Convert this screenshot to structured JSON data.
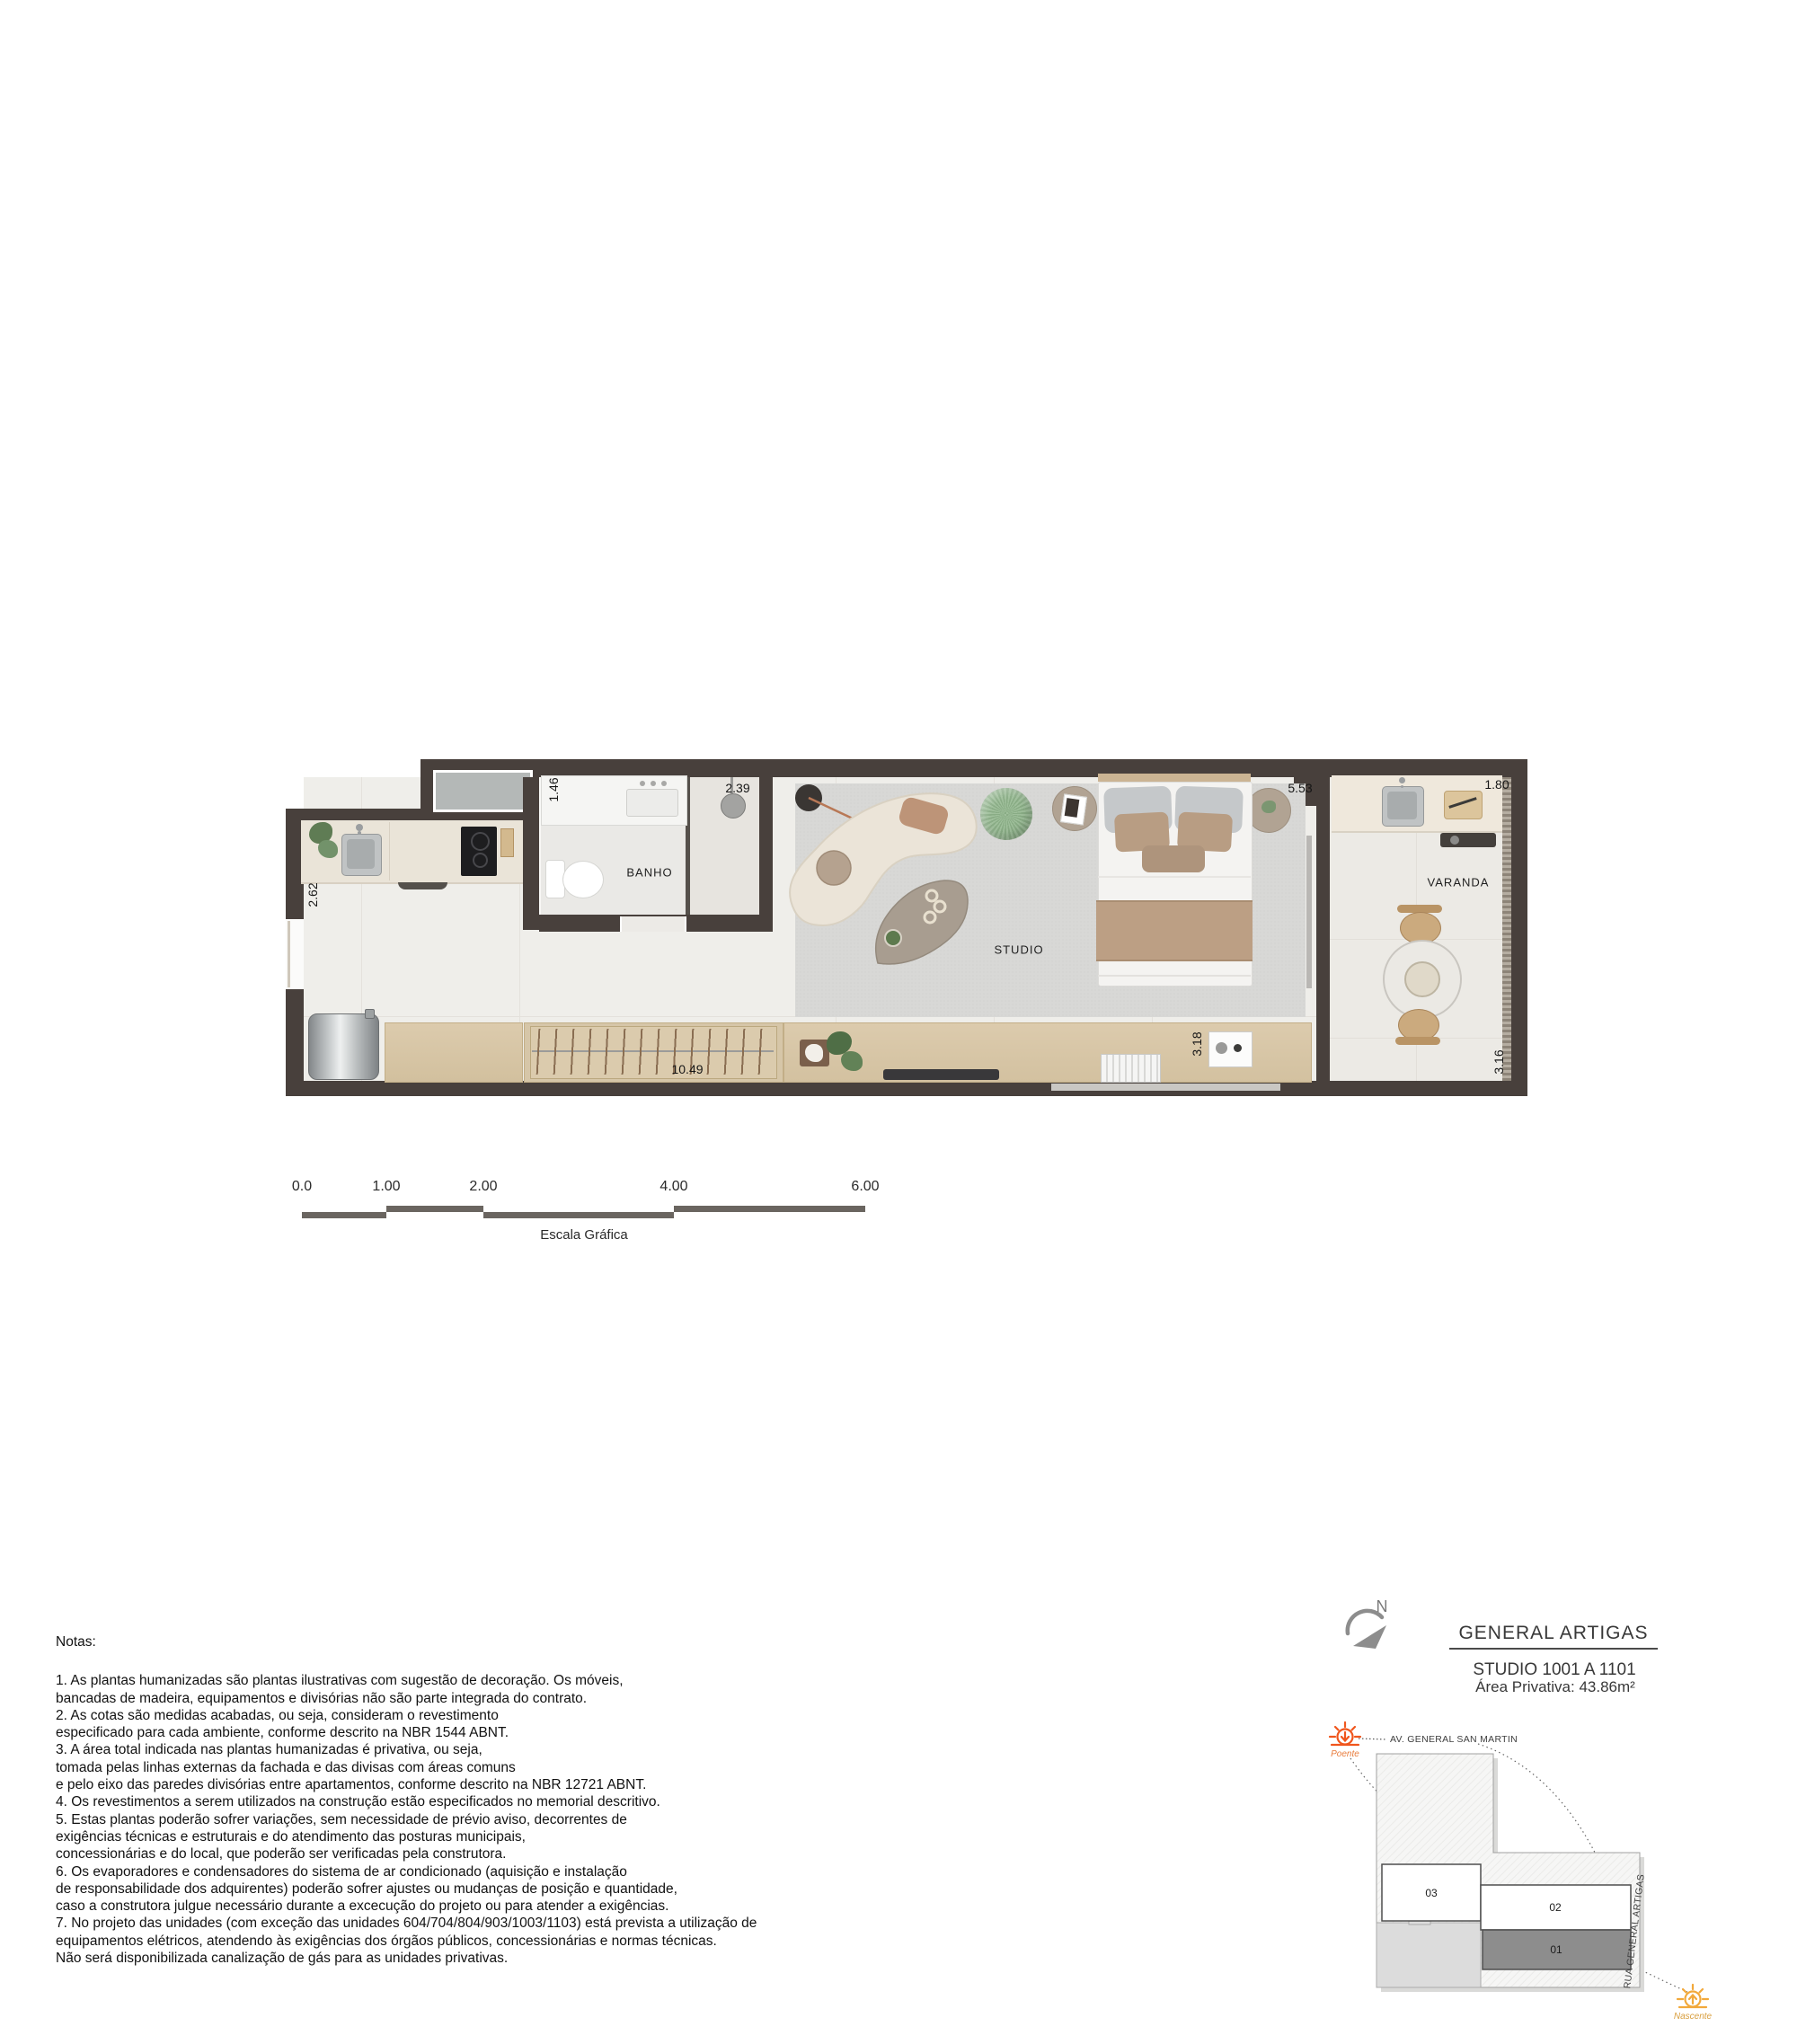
{
  "plan": {
    "room_labels": {
      "bathroom": "BANHO",
      "studio": "STUDIO",
      "balcony": "VARANDA"
    },
    "dimensions": {
      "kitchen_depth": "2.62",
      "bath_width": "1.46",
      "shower_width": "2.39",
      "studio_width": "5.53",
      "balcony_width": "1.80",
      "unit_length": "10.49",
      "console_width": "3.18",
      "balcony_length": "3.16"
    }
  },
  "scale_bar": {
    "ticks": [
      "0.0",
      "1.00",
      "2.00",
      "4.00",
      "6.00"
    ],
    "caption": "Escala Gráfica"
  },
  "notes": {
    "heading": "Notas:",
    "lines": [
      "1. As plantas humanizadas são plantas ilustrativas com sugestão de decoração. Os móveis,",
      "bancadas de madeira, equipamentos e divisórias não são parte integrada do contrato.",
      "2. As cotas são medidas acabadas, ou seja, consideram o revestimento",
      "especificado para cada ambiente, conforme descrito na NBR 1544 ABNT.",
      "3. A área total indicada nas plantas humanizadas é privativa, ou seja,",
      "tomada pelas linhas externas da fachada e das divisas com áreas comuns",
      "e pelo eixo das paredes divisórias entre apartamentos, conforme descrito na NBR 12721 ABNT.",
      "4. Os revestimentos a serem utilizados na construção estão especificados no memorial descritivo.",
      "5. Estas plantas poderão sofrer variações, sem necessidade de prévio aviso, decorrentes de",
      "exigências técnicas e estruturais e do atendimento das posturas municipais,",
      "concessionárias e do local, que poderão ser verificadas pela construtora.",
      "6. Os evaporadores e condensadores do sistema de ar condicionado (aquisição e instalação",
      "de responsabilidade dos adquirentes) poderão sofrer ajustes ou mudanças de posição e quantidade,",
      "caso a construtora julgue necessário durante a excecução do projeto ou para atender a exigências.",
      "7. No projeto das unidades (com exceção das unidades 604/704/804/903/1003/1103) está prevista a utilização de",
      "equipamentos elétricos, atendendo às exigências dos órgãos públicos, concessionárias e normas técnicas.",
      "Não será disponibilizada canalização de gás para as unidades privativas."
    ]
  },
  "title_block": {
    "north": "N",
    "project_name": "GENERAL ARTIGAS",
    "unit_range": "STUDIO 1001 A 1101",
    "private_area": "Área Privativa: 43.86m²"
  },
  "site_map": {
    "street_top": "AV. GENERAL SAN MARTIN",
    "street_right": "RUA GENERAL ARTIGAS",
    "sun_west_label": "Poente",
    "sun_east_label": "Nascente",
    "unit_01": "01",
    "unit_02": "02",
    "unit_03": "03"
  },
  "colors": {
    "wall": "#48403c",
    "accent_orange": "#f0561d",
    "accent_yellow": "#f2a93b",
    "wood": "#d8c8aa",
    "counter": "#eae4d8"
  }
}
